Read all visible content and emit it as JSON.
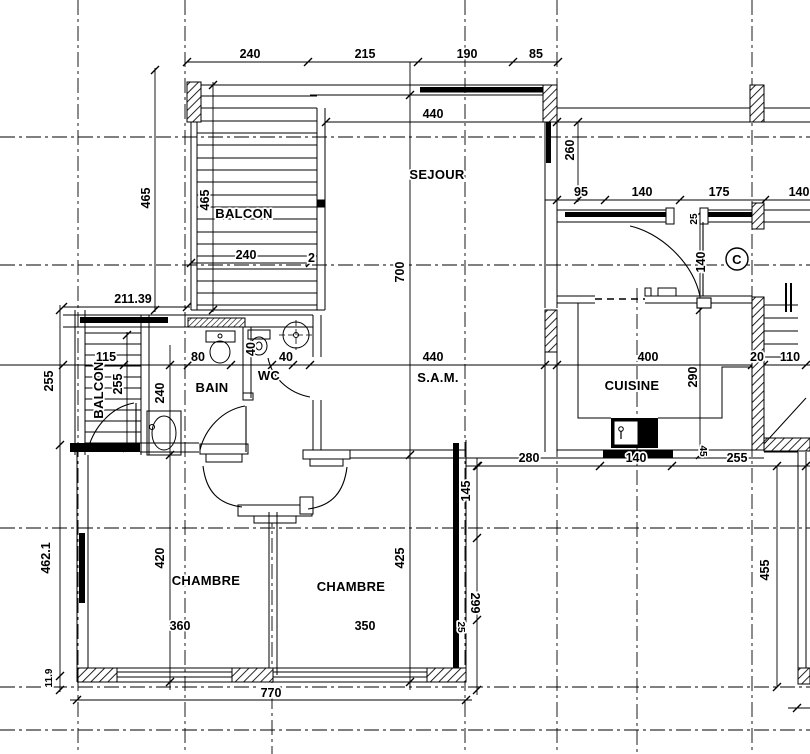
{
  "rooms": {
    "sejour": "SEJOUR",
    "balcon_top": "BALCON",
    "balcon_left": "BALCON",
    "bain": "BAIN",
    "wc": "WC",
    "sam": "S.A.M.",
    "cuisine": "CUISINE",
    "chambre1": "CHAMBRE",
    "chambre2": "CHAMBRE",
    "ref_mark": "C"
  },
  "dims": {
    "top_240": "240",
    "top_215": "215",
    "top_190": "190",
    "top_85": "85",
    "sejour_width": "440",
    "entry_95": "95",
    "entry_140a": "140",
    "entry_175": "175",
    "entry_140b": "140",
    "entry_260": "260",
    "sejour_height": "700",
    "door_140": "140",
    "door_25": "25",
    "balcon_465a": "465",
    "balcon_465b": "465",
    "balcon_240": "240",
    "balcon_2": "2",
    "left_211": "211.39",
    "left_115": "115",
    "bain_80": "80",
    "bain_40": "40",
    "wc_40": "40",
    "left_255a": "255",
    "left_255b": "255",
    "left_240": "240",
    "sam_440": "440",
    "cuisine_400": "400",
    "cuisine_290": "290",
    "right_20": "20",
    "right_110": "110",
    "ter_280": "280",
    "ter_140": "140",
    "ter_255": "255",
    "ter_45": "45",
    "ter_145": "145",
    "ter_299": "299",
    "ter_25": "25",
    "ter_455": "455",
    "ch_4621": "462.1",
    "ch_420": "420",
    "ch_425": "425",
    "ch_360": "360",
    "ch_350": "350",
    "bottom_770": "770",
    "bottom_119": "11.9"
  },
  "colors": {
    "ink": "#000000",
    "paper": "#ffffff"
  }
}
